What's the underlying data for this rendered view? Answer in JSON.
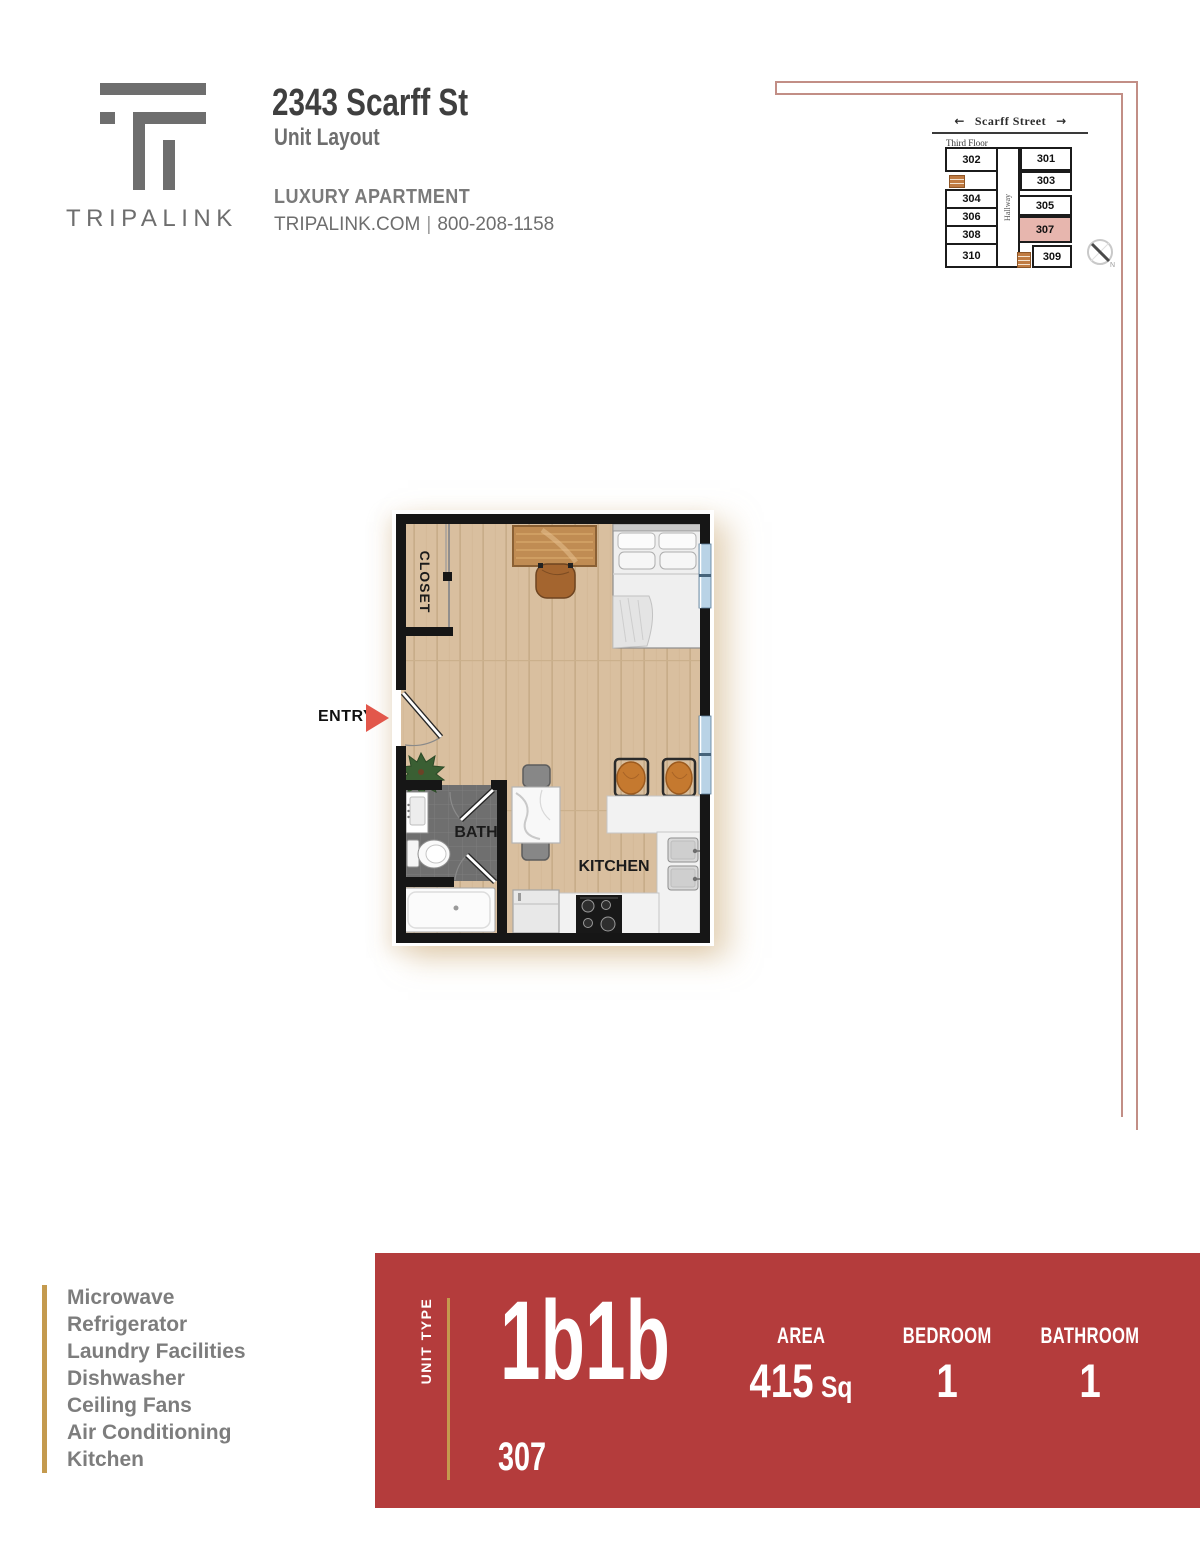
{
  "page": {
    "background": "#ffffff",
    "accent_line_color": "#c28e86"
  },
  "header": {
    "logo_wordmark": "TRIPALINK",
    "logo_color": "#6e6e6e",
    "address": "2343 Scarff St",
    "subtitle": "Unit Layout",
    "tagline": "LUXURY APARTMENT",
    "website": "TRIPALINK.COM",
    "separator": "|",
    "phone": "800-208-1158"
  },
  "minimap": {
    "street_label": "Scarff Street",
    "arrow_left": "←",
    "arrow_right": "→",
    "floor_label": "Third Floor",
    "hallway_label": "Hallway",
    "compass_label": "N",
    "rooms_left": [
      "302",
      "304",
      "306",
      "308",
      "310"
    ],
    "rooms_right": [
      "301",
      "303",
      "305",
      "307",
      "309"
    ],
    "highlighted_room": "307",
    "highlight_color": "#e7b6ae"
  },
  "floorplan": {
    "closet_label": "CLOSET",
    "entry_label": "ENTRY",
    "bath_label": "BATH",
    "kitchen_label": "KITCHEN"
  },
  "amenities": {
    "items": [
      "Microwave",
      "Refrigerator",
      "Laundry Facilities",
      "Dishwasher",
      "Ceiling Fans",
      "Air Conditioning",
      "Kitchen"
    ]
  },
  "banner": {
    "background": "#b43c3c",
    "gold_accent": "#c49a4e",
    "unit_type_label": "UNIT TYPE",
    "unit_type": "1b1b",
    "area_label": "AREA",
    "area_value": "415",
    "area_unit": "Sq",
    "bedroom_label": "BEDROOM",
    "bedroom_count": "1",
    "bathroom_label": "BATHROOM",
    "bathroom_count": "1",
    "unit_number": "307"
  }
}
